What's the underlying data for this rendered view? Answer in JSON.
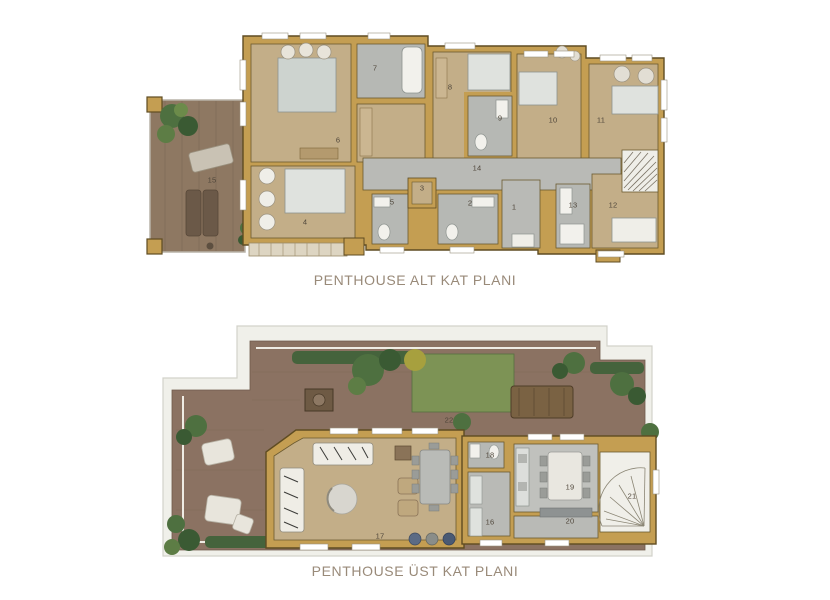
{
  "document": {
    "type": "architectural-floor-plans",
    "background": "#ffffff"
  },
  "plans": [
    {
      "id": "lower",
      "title": "PENTHOUSE ALT KAT PLANI",
      "rooms": [
        {
          "label": "1",
          "x": 514,
          "y": 207
        },
        {
          "label": "2",
          "x": 470,
          "y": 203
        },
        {
          "label": "3",
          "x": 422,
          "y": 188
        },
        {
          "label": "4",
          "x": 305,
          "y": 222
        },
        {
          "label": "5",
          "x": 392,
          "y": 202
        },
        {
          "label": "6",
          "x": 338,
          "y": 140
        },
        {
          "label": "7",
          "x": 375,
          "y": 68
        },
        {
          "label": "8",
          "x": 450,
          "y": 87
        },
        {
          "label": "9",
          "x": 500,
          "y": 118
        },
        {
          "label": "10",
          "x": 553,
          "y": 120
        },
        {
          "label": "11",
          "x": 601,
          "y": 120
        },
        {
          "label": "12",
          "x": 613,
          "y": 205
        },
        {
          "label": "13",
          "x": 573,
          "y": 205
        },
        {
          "label": "14",
          "x": 477,
          "y": 168
        },
        {
          "label": "15",
          "x": 212,
          "y": 180
        }
      ]
    },
    {
      "id": "upper",
      "title": "PENTHOUSE ÜST KAT PLANI",
      "rooms": [
        {
          "label": "16",
          "x": 490,
          "y": 522
        },
        {
          "label": "17",
          "x": 380,
          "y": 536
        },
        {
          "label": "18",
          "x": 490,
          "y": 455
        },
        {
          "label": "19",
          "x": 570,
          "y": 487
        },
        {
          "label": "20",
          "x": 570,
          "y": 521
        },
        {
          "label": "21",
          "x": 632,
          "y": 496
        },
        {
          "label": "22",
          "x": 449,
          "y": 420
        }
      ]
    }
  ],
  "colors": {
    "wall": "#c49e52",
    "wall_outline": "#5f4c22",
    "room_floor": "#c3ae88",
    "wet_room_floor": "#b6b8b4",
    "terrace_wood": "#8b7262",
    "grass": "#7d9355",
    "hedge": "#45633c",
    "roof_band": "#f0f0ea",
    "title_text": "#998a79"
  }
}
